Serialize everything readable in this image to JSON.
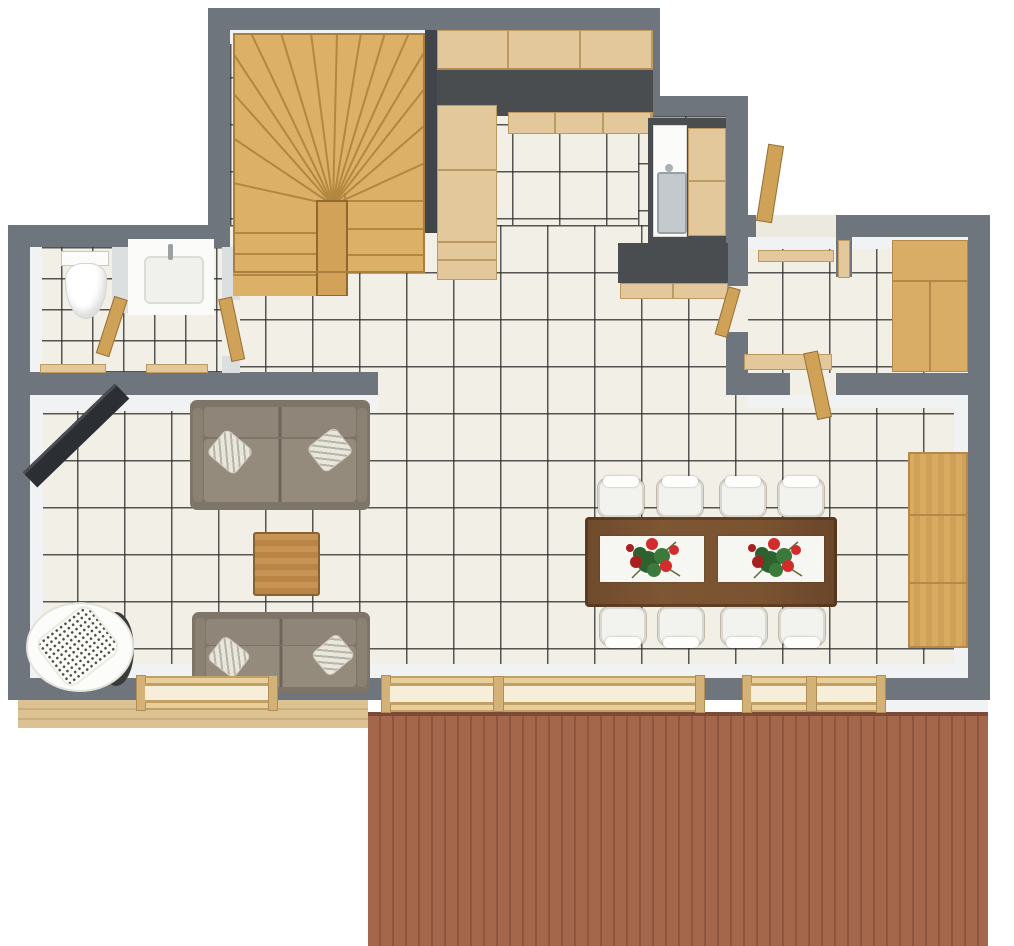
{
  "meta": {
    "title": "3D top-down floor plan rendering, ground floor with terrace",
    "view": "orthographic top-down 3D render",
    "visible_text": "none"
  },
  "colors": {
    "wall": "#6f757c",
    "wall_light": "#dcdfe0",
    "face": "#f1f2f3",
    "tile": "#f2efe6",
    "grout": "rgba(45,45,45,0.8)",
    "wood_light": "#e3c89c",
    "wood_line": "#bd9a62",
    "wood_mid": "#d9ad66",
    "wood_door": "#cfa258",
    "wood_stair": "#dcb066",
    "wood_stair_line": "#b3873e",
    "counter": "#4a4d50",
    "deck": "#a5674c",
    "deck_line": "#8f563f",
    "fascia": "#dcc192",
    "fascia_line": "#cbb07e",
    "win_frame": "#e8cf9a",
    "table": "#7a5331",
    "table_edge": "#5e3f26",
    "runner": "#f6f6f2",
    "sofa_frame": "#7e7568",
    "sofa_cushion": "#8f8679",
    "sofa_cushion2": "#948b7d",
    "sofa_seam": "#6e6559",
    "pillow": "#e9e6da",
    "chair": "#f2f2ee",
    "chair_shadow": "#d9d8d0",
    "fixture": "#fbfbf9",
    "steel": "#c3c9cd",
    "tv": "#2b2e32",
    "flower_red": "#d22c2c",
    "flower_red_dark": "#a81f1f",
    "flower_green": "#2d6130",
    "flower_green2": "#3b7a3b"
  },
  "rooms": [
    {
      "id": "staircase-hall",
      "feature": "U-shaped winder staircase in light wood"
    },
    {
      "id": "kitchen",
      "feature": "L-shaped dark countertop with light wood cabinets and sink niche"
    },
    {
      "id": "wc",
      "feature": "toilet with cistern"
    },
    {
      "id": "bathroom",
      "feature": "white washbasin / shower unit"
    },
    {
      "id": "entry-hall",
      "feature": "front door porch, bench and open doors"
    },
    {
      "id": "storage-room",
      "feature": "large light wood wardrobe"
    },
    {
      "id": "living-room",
      "feature": "two taupe sofas, coffee table, lounge chair, wall TV"
    },
    {
      "id": "dining-area",
      "feature": "dark wood table for eight with flower centerpieces and sideboard"
    },
    {
      "id": "terrace",
      "feature": "red-brown plank deck along bottom"
    }
  ],
  "furniture": [
    {
      "name": "winder-staircase",
      "room": "staircase-hall"
    },
    {
      "name": "upper-cabinets",
      "room": "kitchen"
    },
    {
      "name": "counter-run",
      "room": "kitchen"
    },
    {
      "name": "tall-cabinet",
      "room": "kitchen"
    },
    {
      "name": "base-cabinets",
      "room": "kitchen"
    },
    {
      "name": "sink-unit",
      "room": "kitchen"
    },
    {
      "name": "niche-cabinet",
      "room": "kitchen"
    },
    {
      "name": "peninsula-counter",
      "room": "kitchen"
    },
    {
      "name": "toilet",
      "room": "wc"
    },
    {
      "name": "washbasin",
      "room": "bathroom"
    },
    {
      "name": "wardrobe",
      "room": "storage-room"
    },
    {
      "name": "bench",
      "room": "entry-hall"
    },
    {
      "name": "dining-table",
      "room": "dining-area"
    },
    {
      "name": "dining-chairs",
      "room": "dining-area",
      "count": 8
    },
    {
      "name": "table-runners",
      "room": "dining-area",
      "count": 2
    },
    {
      "name": "flower-centerpieces",
      "room": "dining-area",
      "count": 2
    },
    {
      "name": "sideboard",
      "room": "dining-area"
    },
    {
      "name": "sofa-large",
      "room": "living-room"
    },
    {
      "name": "sofa-small",
      "room": "living-room"
    },
    {
      "name": "coffee-table",
      "room": "living-room"
    },
    {
      "name": "lounge-chair",
      "room": "living-room"
    },
    {
      "name": "wall-tv",
      "room": "living-room"
    },
    {
      "name": "window-living",
      "room": "living-room"
    },
    {
      "name": "sliding-door-large",
      "room": "dining-area"
    },
    {
      "name": "sliding-door-small",
      "room": "dining-area"
    },
    {
      "name": "deck",
      "room": "terrace"
    }
  ]
}
